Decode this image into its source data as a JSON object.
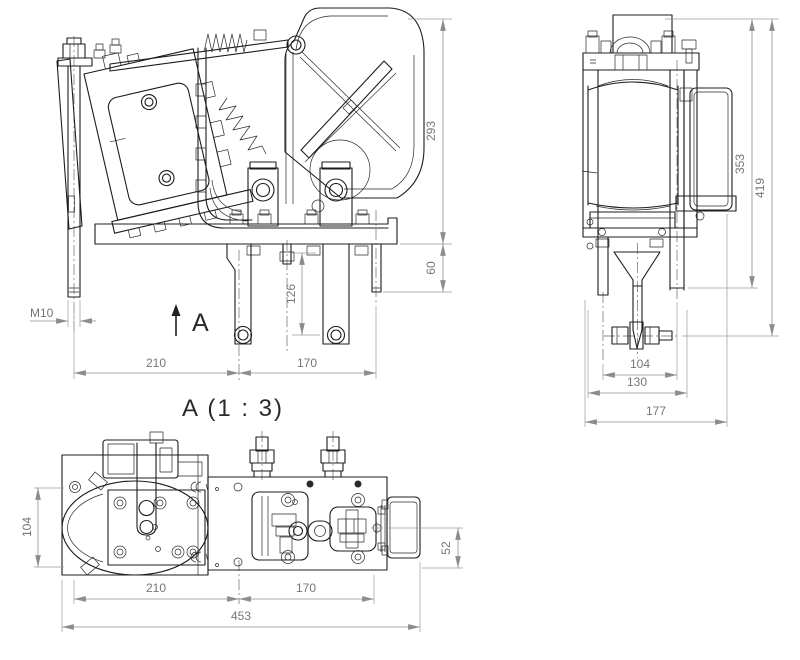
{
  "drawing_title": {
    "detail_view": "A (1 : 3)",
    "view_arrow": "A"
  },
  "front_view_dims": {
    "overall_height": "293",
    "rod_projection": "60",
    "terminal_depth": "126",
    "left_span": "210",
    "right_span": "170",
    "thread_size": "M10"
  },
  "side_view_dims": {
    "body_height": "353",
    "overall_height": "419",
    "rod_spacing": "104",
    "frame_width": "130",
    "overall_width": "177"
  },
  "plan_view_dims": {
    "body_depth": "104",
    "left_span": "210",
    "right_span": "170",
    "overall_length": "453",
    "terminal_offset": "52"
  },
  "colors": {
    "line": "#1c1c1c",
    "dimension": "#8c8c8c",
    "background": "#ffffff"
  }
}
